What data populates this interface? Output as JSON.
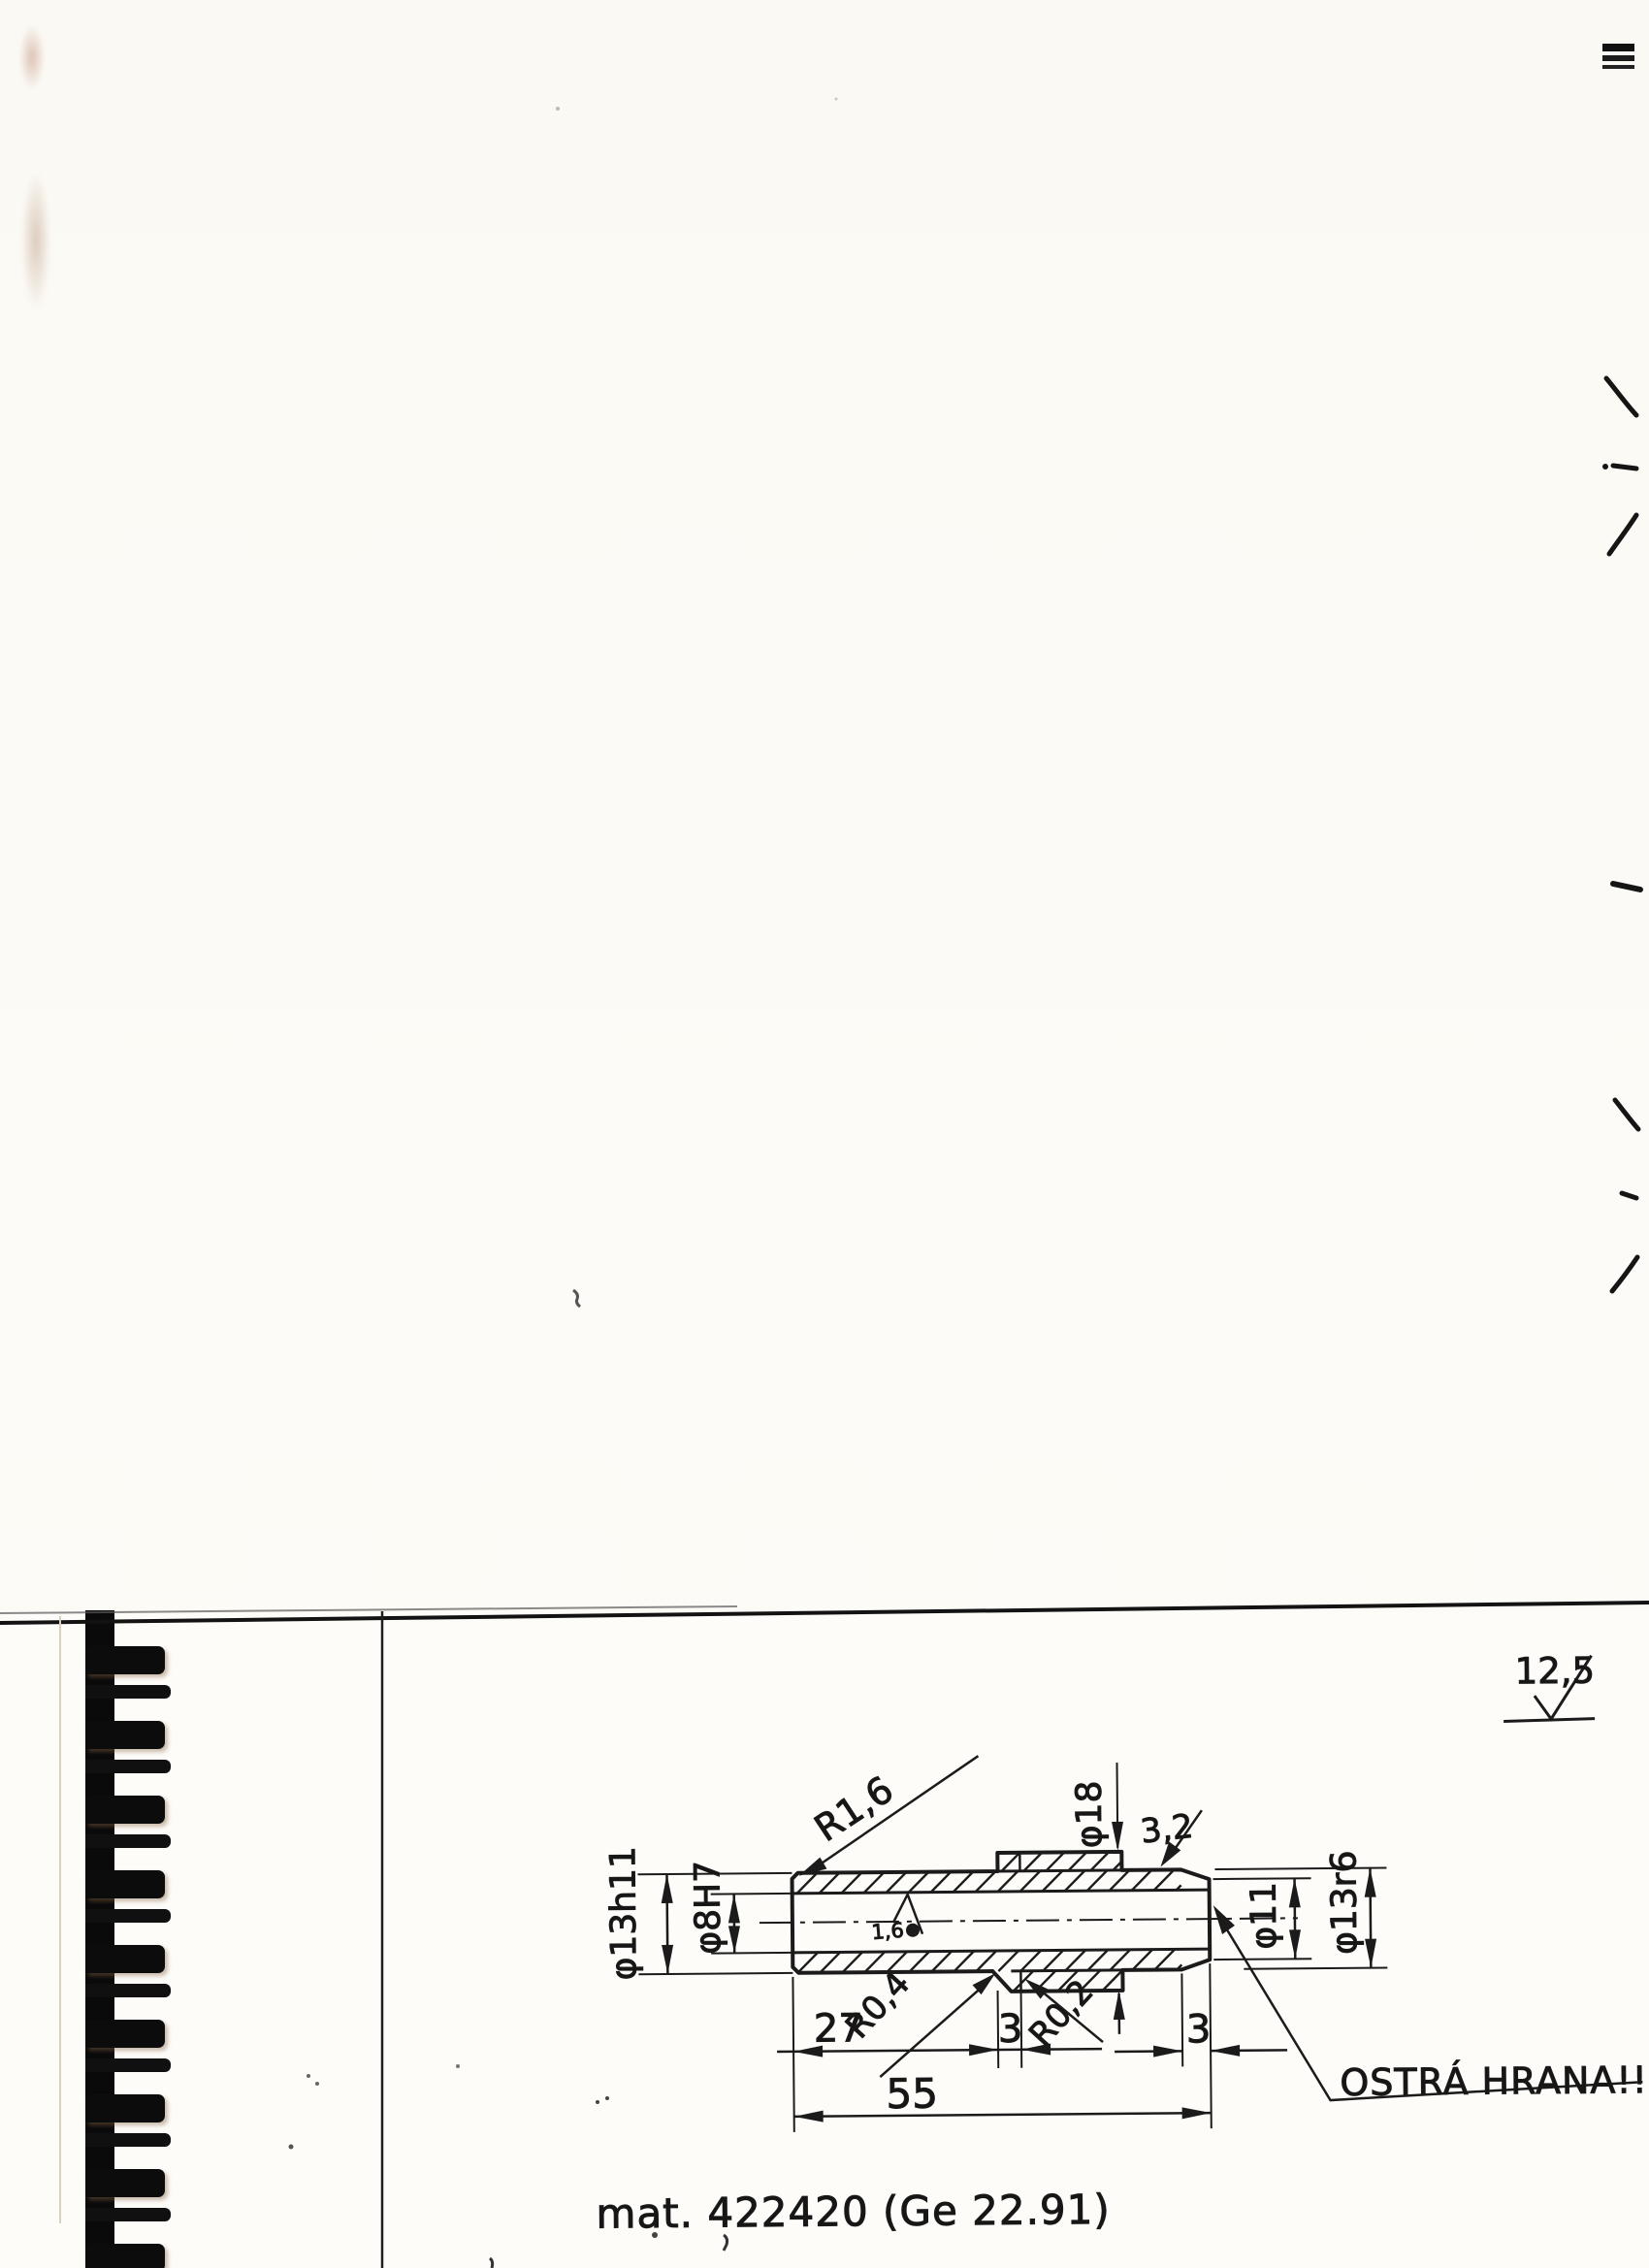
{
  "colors": {
    "ink": "#1b1b1b",
    "paper": "#fbf9f4"
  },
  "drawing": {
    "surface_note": "12,5",
    "labels": {
      "radius_left": "R1,6",
      "collar_dia": "φ18",
      "chamfer": "3,2",
      "outer_dia_left": "φ13h11",
      "bore_dia": "φ8H7",
      "end_dia": "φ11",
      "outer_dia_right": "φ13r6",
      "groove_radius_left": "R0,4",
      "groove_radius_right": "R0,2",
      "bore_roughness": "1,6"
    },
    "dimensions": {
      "len_left": "27",
      "groove_width": "3",
      "end_width": "3",
      "total_length": "55"
    },
    "sharp_edge_note": "OSTRÁ HRANA!!",
    "material_note": "mat. 422420  (Ge 22.91)"
  }
}
